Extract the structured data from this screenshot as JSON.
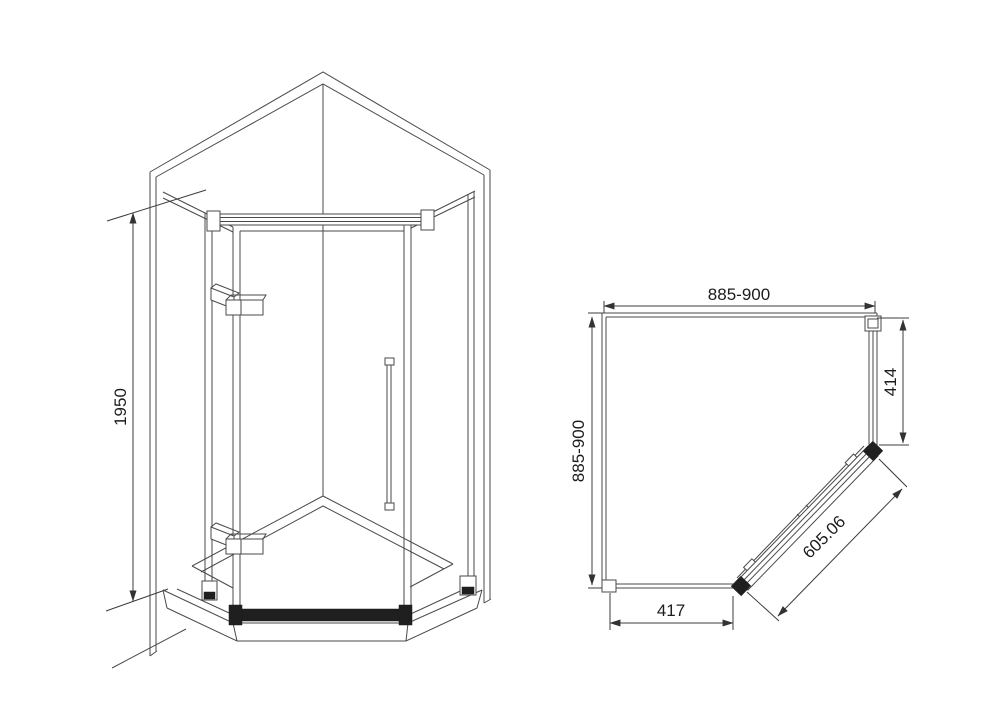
{
  "drawing": {
    "type": "technical-diagram",
    "subject": "pentagon-corner-shower-enclosure",
    "background": "#ffffff"
  },
  "front_view": {
    "height_dim": "1950"
  },
  "plan_view": {
    "width_dim": "885-900",
    "depth_dim": "885-900",
    "side_panel_dim": "414",
    "door_dim": "605.06",
    "front_panel_dim": "417"
  },
  "colors": {
    "line": "#4a4a4a",
    "dimension_line": "#3c3c3c",
    "dark_fill": "#1f1f1f",
    "text": "#1c1c1c",
    "background": "#ffffff"
  }
}
